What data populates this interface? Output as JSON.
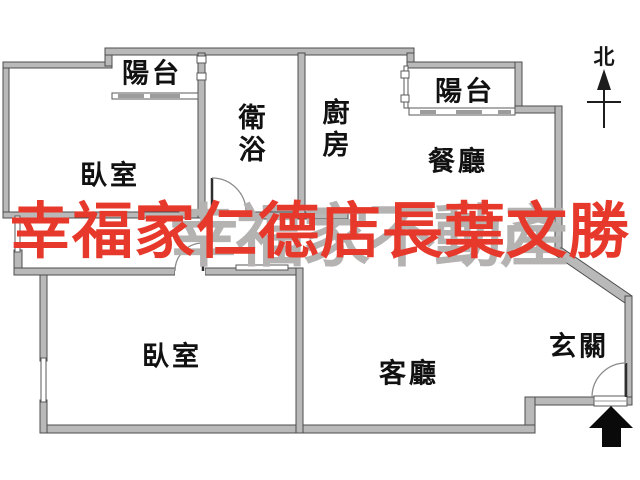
{
  "title": "apartment floor plan",
  "colors": {
    "wall_fill": "#b9b9b9",
    "wall_stroke": "#4d4d4d",
    "label_color": "#111111",
    "wm_red": "#e6392b",
    "wm_gray": "#b5b2b2",
    "arrow_black": "#0a0a0a"
  },
  "rooms": [
    {
      "id": "balcony-top-left",
      "label": "陽台"
    },
    {
      "id": "bedroom-top",
      "label": "臥室"
    },
    {
      "id": "bathroom",
      "label": "衛浴"
    },
    {
      "id": "kitchen",
      "label": "廚房"
    },
    {
      "id": "balcony-top-right",
      "label": "陽台"
    },
    {
      "id": "dining-room",
      "label": "餐廳"
    },
    {
      "id": "bedroom-bottom",
      "label": "臥室"
    },
    {
      "id": "living-room",
      "label": "客廳"
    },
    {
      "id": "entryway",
      "label": "玄關"
    }
  ],
  "compass": {
    "label": "北"
  },
  "watermark": {
    "red_text": "幸福家仁德店長葉文勝",
    "gray_text": "幸福家不動產"
  }
}
